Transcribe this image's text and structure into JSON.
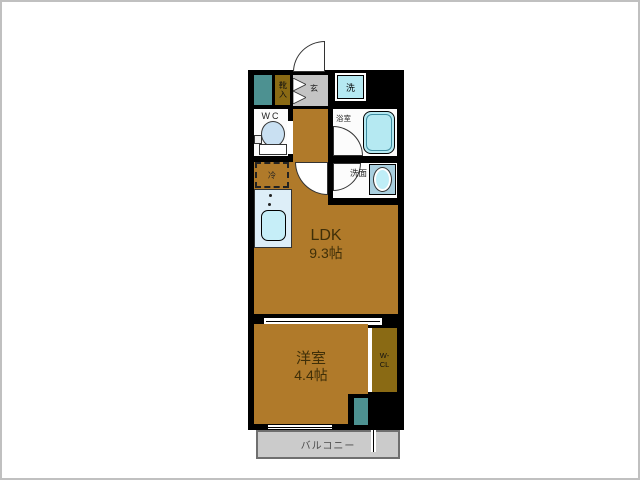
{
  "rooms": {
    "ldk": {
      "label": "LDK",
      "size": "9.3帖"
    },
    "bedroom": {
      "label": "洋室",
      "size": "4.4帖"
    },
    "wc": {
      "label": "WC"
    },
    "bath": {
      "label": "浴室"
    },
    "washroom": {
      "label": "洗面"
    },
    "balcony": {
      "label": "バルコニー"
    }
  },
  "fixtures": {
    "laundry": "洗",
    "entrance": "玄",
    "shoe_cabinet": "靴入",
    "fridge": "冷",
    "closet_line1": "W-",
    "closet_line2": "CL"
  },
  "colors": {
    "wall": "#000000",
    "floor": "#b07a2a",
    "storage": "#8a6a14",
    "pipe_space": "#4d9191",
    "entrance_floor": "#c4c4c4",
    "fixture_blue": "#b5e9f2",
    "counter_blue": "#ddeef8",
    "toilet_blue": "#c9e0f2",
    "balcony_gray": "#cbcbcb",
    "balcony_border": "#6f6f6f",
    "label_brown": "#3f2f08"
  }
}
